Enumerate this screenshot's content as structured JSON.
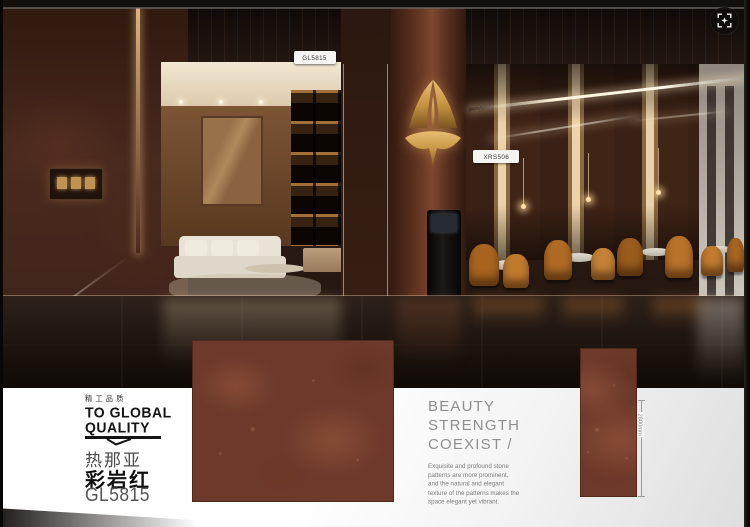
{
  "ui": {
    "expand_button_icon": "scan-expand-icon"
  },
  "scene": {
    "hotspot_tags": [
      {
        "label": "GL5815"
      },
      {
        "label": "XRS506"
      }
    ]
  },
  "branding": {
    "tagline_cn": "精工品质",
    "tagline_en_line1": "TO GLOBAL",
    "tagline_en_line2": "QUALITY"
  },
  "product": {
    "series_cn": "热那亚",
    "name_cn": "彩岩红",
    "code": "GL5815"
  },
  "slogan": {
    "line1": "BEAUTY",
    "line2": "STRENGTH",
    "line3": "COEXIST /"
  },
  "description_text": "Exquisite and profound stone patterns are more prominent, and the natural and elegant texture of the patterns makes the space elegant yet vibrant.",
  "dimension": {
    "label": "2800mm"
  },
  "palette": {
    "tile_red": "#6d392a",
    "tile_red_light": "#8a5038",
    "gold": "#d0a055",
    "amber_chair": "#b46a28",
    "text_dark": "#141414",
    "text_gray": "#8f8f8f"
  }
}
